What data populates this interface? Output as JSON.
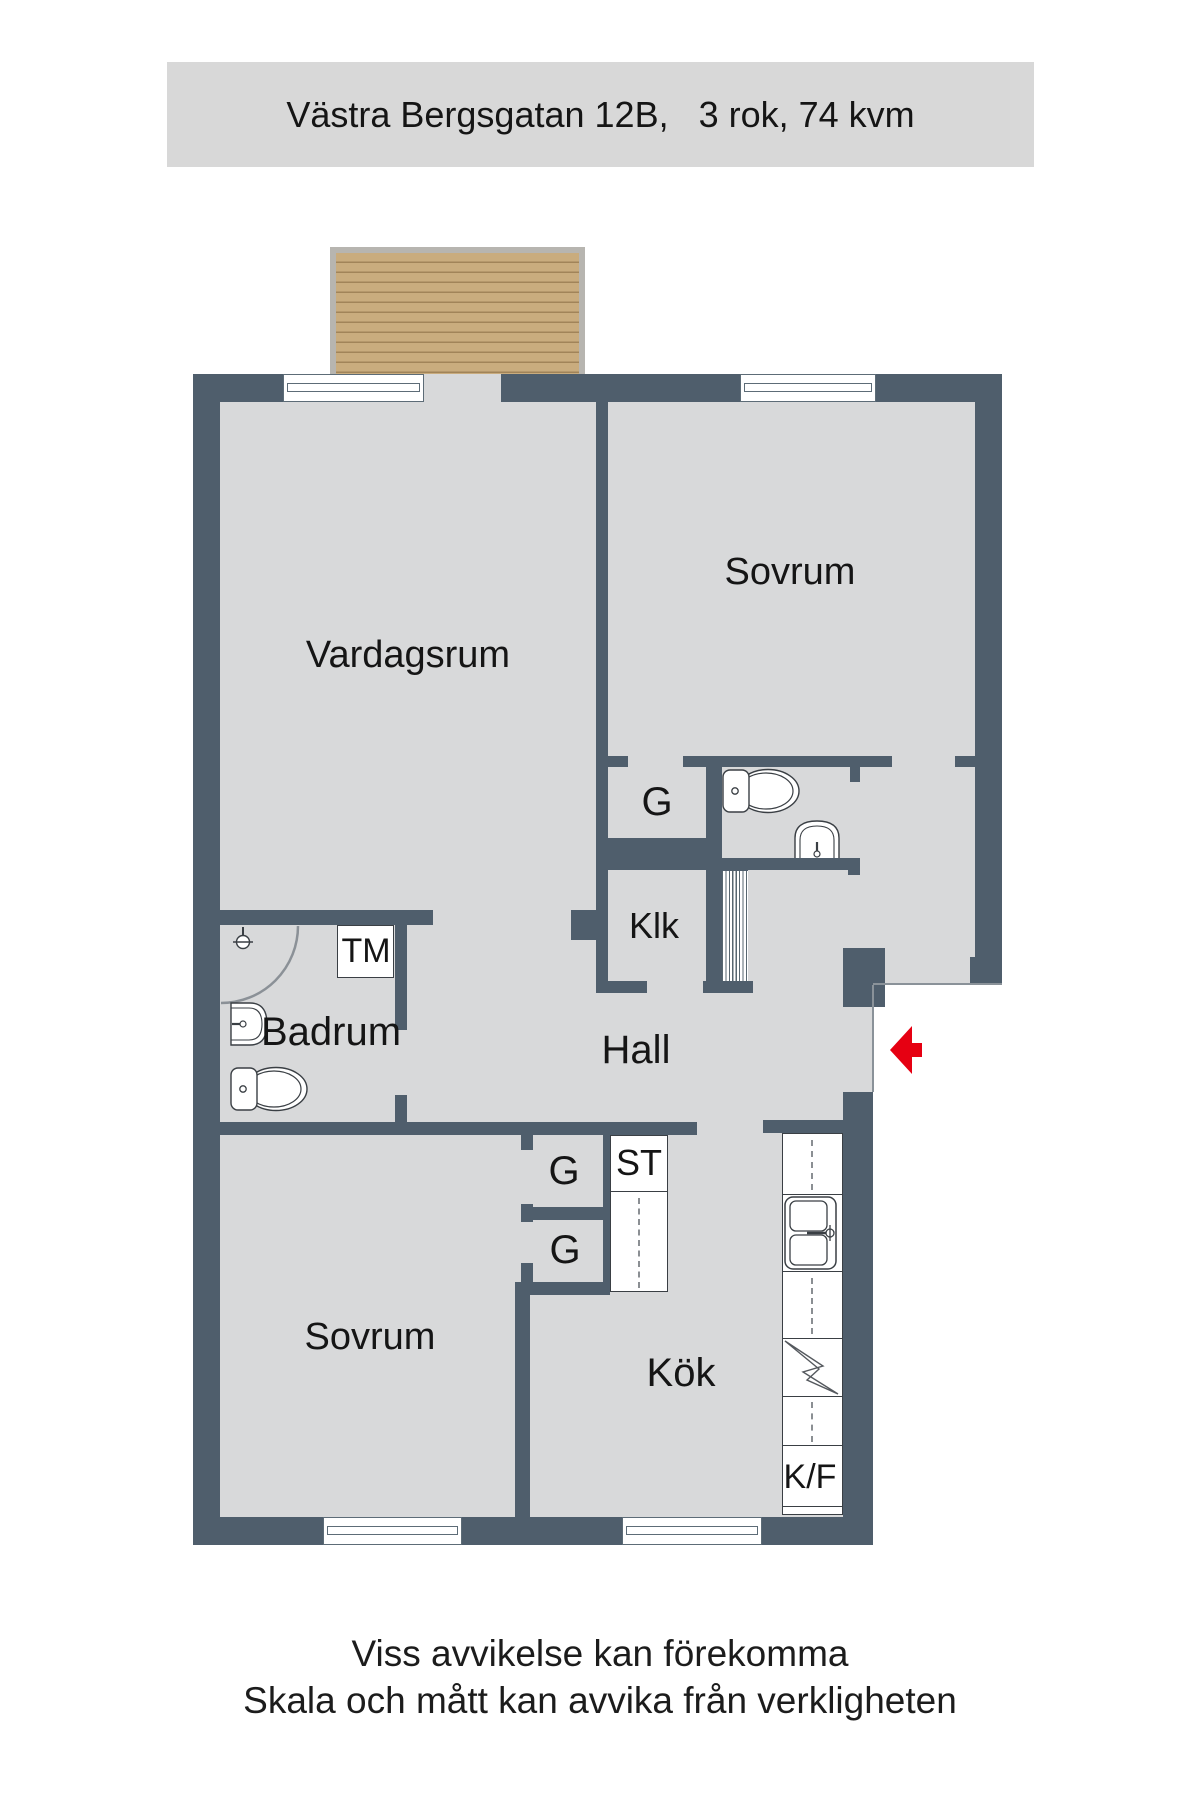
{
  "header": {
    "title": "Västra Bergsgatan 12B,   3 rok, 74 kvm"
  },
  "rooms": {
    "vardagsrum": "Vardagsrum",
    "sovrum_1": "Sovrum",
    "sovrum_2": "Sovrum",
    "kok": "Kök",
    "hall": "Hall",
    "badrum": "Badrum",
    "klk": "Klk"
  },
  "closets": {
    "g_upper": "G",
    "g1": "G",
    "g2": "G",
    "st": "ST"
  },
  "appliances": {
    "tm": "TM",
    "kf": "K/F"
  },
  "footer": {
    "line1": "Viss avvikelse kan förekomma",
    "line2": "Skala och mått kan avvika från verkligheten"
  },
  "icons": {
    "entrance_arrow": "entrance-arrow-icon",
    "toilet": "toilet-icon",
    "sink": "sink-icon",
    "shower": "shower-icon",
    "kitchen_sink": "kitchen-sink-icon",
    "stove": "stove-icon"
  },
  "colors": {
    "wall": "#4f5e6c",
    "floor": "#d8d9da",
    "header_bg": "#d8d8d8",
    "arrow_red": "#e60012",
    "balcony_wood": "#c9ac7e"
  }
}
